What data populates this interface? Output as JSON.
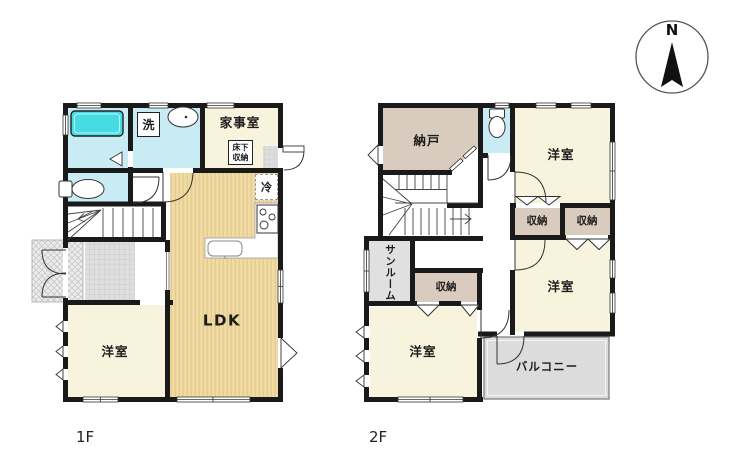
{
  "compass": {
    "north": "N"
  },
  "floor1": {
    "label": "1F",
    "rooms": {
      "laundry": "洗",
      "utility": "家事室",
      "underfloor_line1": "床下",
      "underfloor_line2": "収納",
      "fridge": "冷",
      "ldk": "LDK",
      "western": "洋室"
    }
  },
  "floor2": {
    "label": "2F",
    "rooms": {
      "storeroom": "納戸",
      "western_ne": "洋室",
      "closet_a": "収納",
      "closet_b": "収納",
      "closet_c": "収納",
      "sunroom": "サンルーム",
      "western_e": "洋室",
      "western_sw": "洋室",
      "balcony": "バルコニー"
    }
  },
  "palette": {
    "wall": "#1a1a1a",
    "wet_floor": "#c9ebf3",
    "bathtub": "#45dce4",
    "cream_room": "#f8f3dc",
    "ldk_floor": "#f0dba4",
    "ldk_stripe": "#e5cd90",
    "storage_tan": "#d9ccbf",
    "sunroom_gray": "#e0e0e0",
    "balcony_gray": "#dcdcdc"
  }
}
